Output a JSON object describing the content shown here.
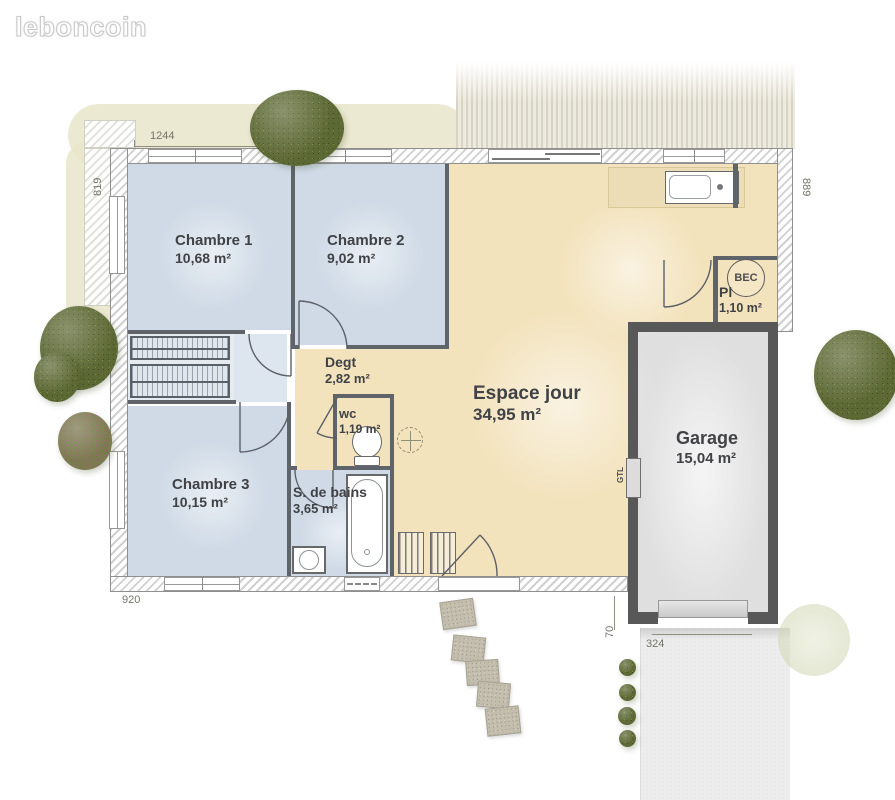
{
  "logo": {
    "text": "leboncoin"
  },
  "rooms": [
    {
      "name": "Chambre 1",
      "area": "10,68 m²"
    },
    {
      "name": "Chambre 2",
      "area": "9,02 m²"
    },
    {
      "name": "Chambre 3",
      "area": "10,15 m²"
    },
    {
      "name": "Degt",
      "area": "2,82 m²"
    },
    {
      "name": "wc",
      "area": "1,19 m²"
    },
    {
      "name": "S. de bains",
      "area": "3,65 m²"
    },
    {
      "name": "Espace jour",
      "area": "34,95 m²"
    },
    {
      "name": "Pl",
      "area": "1,10 m²"
    },
    {
      "name": "Garage",
      "area": "15,04 m²"
    }
  ],
  "equipment": {
    "water_heater": "BEC",
    "technical_box": "GTL"
  },
  "dimensions": {
    "top_width": "1244",
    "left_height": "819",
    "right_height": "889",
    "bottom_width": "920",
    "garage_offset": "70",
    "garage_door_width": "324"
  },
  "colors": {
    "bedroom_floor": "#cfdae6",
    "living_floor": "#f3e3bd",
    "garage_floor": "#e3e3e3",
    "wall_dark": "#5f646b",
    "terrace": "#d8d4c5",
    "bush_green": "#5d6934",
    "driveway": "#ededed"
  }
}
